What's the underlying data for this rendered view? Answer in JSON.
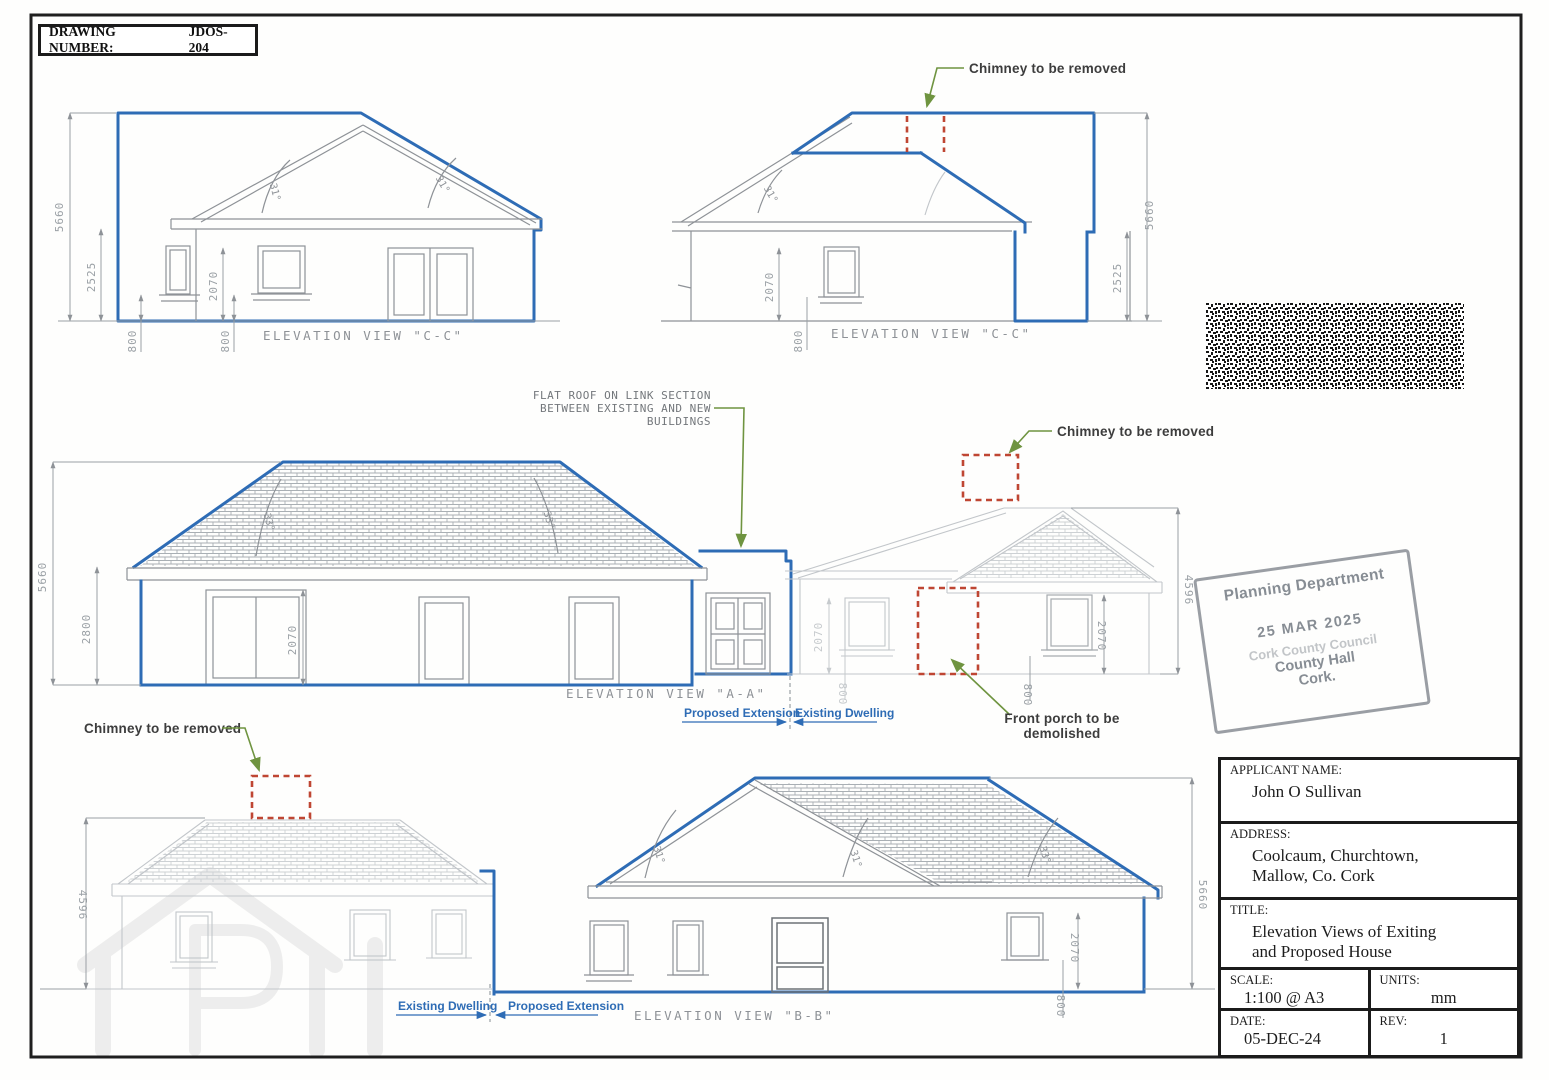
{
  "meta": {
    "drawing_number_label": "DRAWING NUMBER:",
    "drawing_number_value": "JDOS-204"
  },
  "labels": {
    "view_cc": "ELEVATION VIEW \"C-C\"",
    "view_aa": "ELEVATION VIEW \"A-A\"",
    "view_bb": "ELEVATION VIEW \"B-B\"",
    "chimney": "Chimney to be removed",
    "flat_roof_1": "FLAT ROOF ON LINK SECTION",
    "flat_roof_2": "BETWEEN EXISTING AND NEW",
    "flat_roof_3": "BUILDINGS",
    "porch_1": "Front porch to be",
    "porch_2": "demolished",
    "proposed_extension": "Proposed Extension",
    "existing_dwelling": "Existing Dwelling"
  },
  "dims": {
    "h5660": "5660",
    "h2525": "2525",
    "h2070": "2070",
    "h800": "800",
    "h2800": "2800",
    "h4596": "4596",
    "a31": "31°",
    "a33": "33°"
  },
  "barcode": {
    "caption": "234083-25/02/2025-F2 Elevations"
  },
  "stamp": {
    "line1": "Planning Department",
    "line2": "25 MAR 2025",
    "line3": "Cork County Council",
    "line4": "County Hall",
    "line5": "Cork."
  },
  "title_block": {
    "applicant_label": "APPLICANT NAME:",
    "applicant": "John O Sullivan",
    "address_label": "ADDRESS:",
    "address_1": "Coolcaum, Churchtown,",
    "address_2": "Mallow, Co. Cork",
    "title_label": "TITLE:",
    "title_1": "Elevation Views of Exiting",
    "title_2": "and Proposed House",
    "scale_label": "SCALE:",
    "scale": "1:100 @ A3",
    "units_label": "UNITS:",
    "units": "mm",
    "date_label": "DATE:",
    "date": "05-DEC-24",
    "rev_label": "REV:",
    "rev": "1"
  },
  "colors": {
    "blue": "#2e6cb5",
    "red": "#bf4633",
    "green": "#6f9440",
    "grey": "#8e9297"
  }
}
